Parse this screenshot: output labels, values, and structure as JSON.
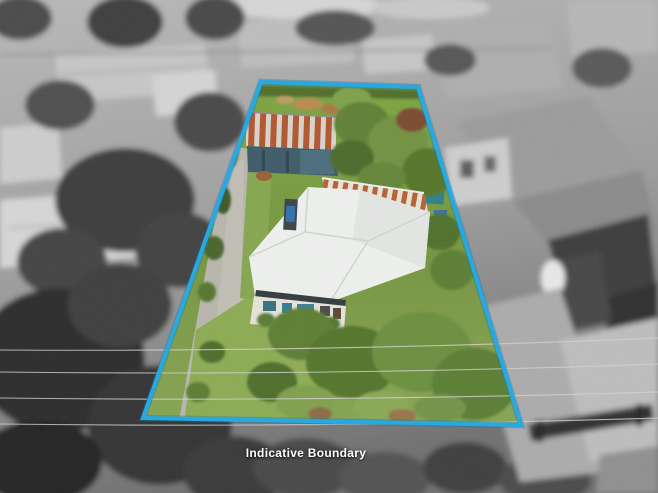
{
  "scene": {
    "caption": "Indicative Boundary"
  },
  "palette": {
    "boundary_blue": "#1FA8E4",
    "boundary_shadow": "#0E6FA3",
    "caption_text": "#FFFFFF",
    "lawn_green": "#7E9F48",
    "front_lawn_green": "#8CAB52",
    "house_roof_white": "#EFF1EF",
    "shed_rust": "#B0562F",
    "shed_iron": "#D8D4CB",
    "shed_wall_blue": "#3D5A68",
    "driveway_grey": "#B8B6AC",
    "wire_grey": "#D4D4D4",
    "background_grey": "#A6A6A6"
  }
}
